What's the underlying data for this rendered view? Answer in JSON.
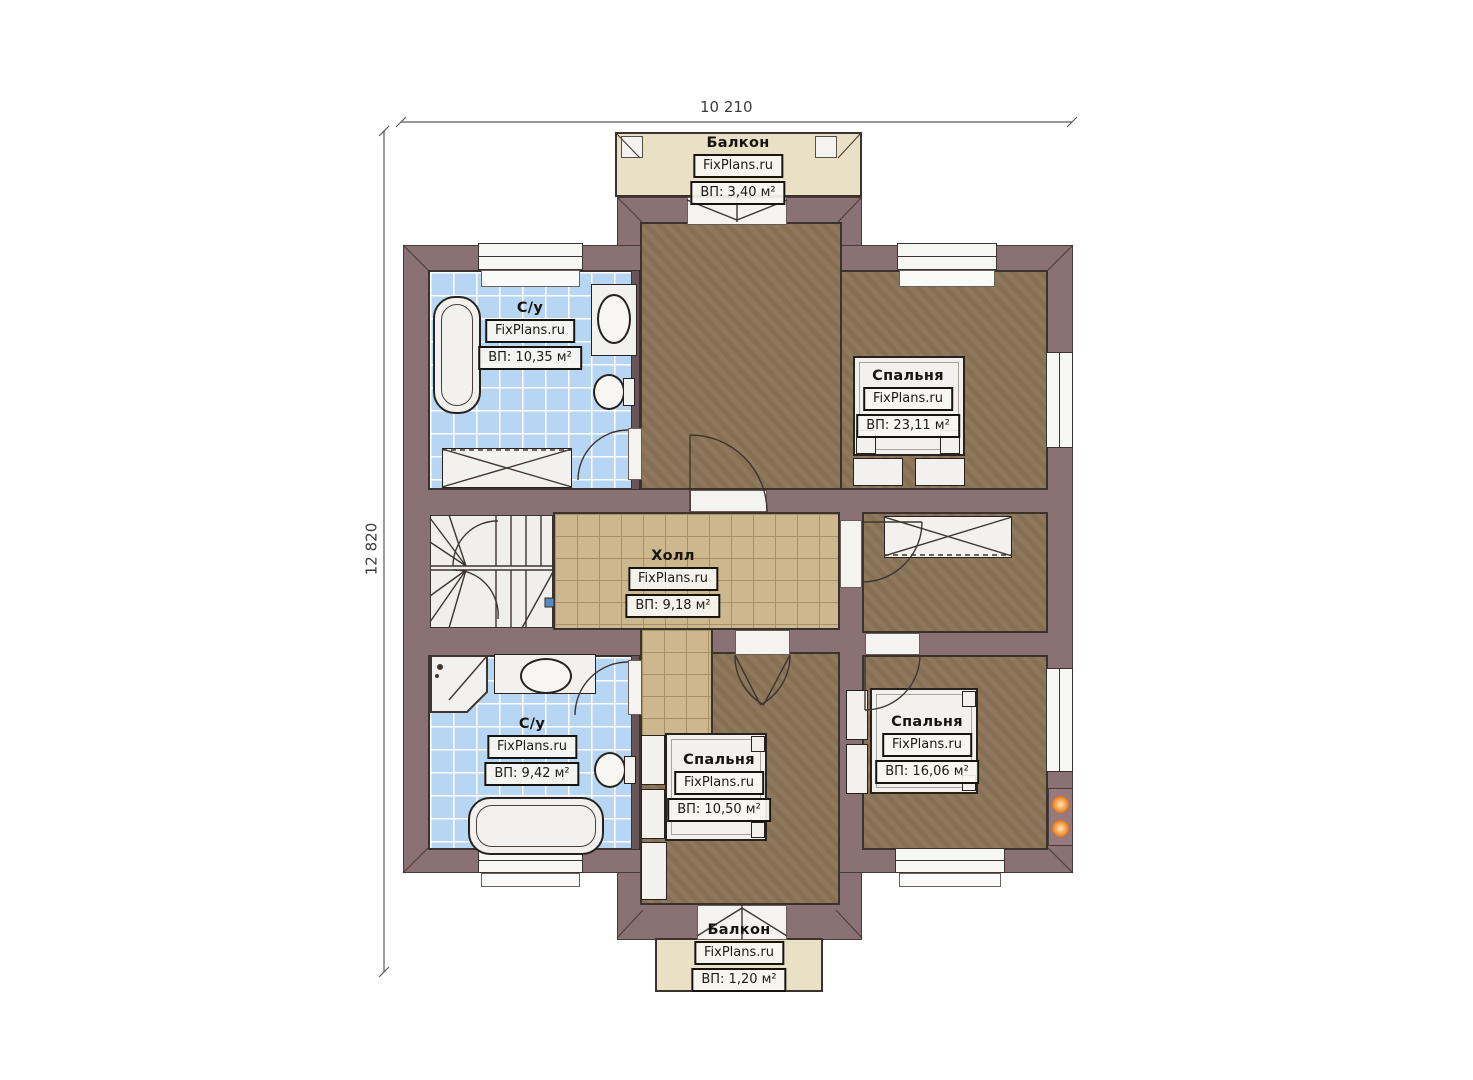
{
  "brand": "FixPlans.ru",
  "dimensions": {
    "width_label": "10 210",
    "height_label": "12 820"
  },
  "rooms": {
    "balcony_top": {
      "name": "Балкон",
      "area": "ВП: 3,40 м²"
    },
    "bathroom_top": {
      "name": "С/у",
      "area": "ВП: 10,35 м²"
    },
    "bedroom_main": {
      "name": "Спальня",
      "area": "ВП: 23,11 м²"
    },
    "hall": {
      "name": "Холл",
      "area": "ВП: 9,18 м²"
    },
    "bathroom_bottom": {
      "name": "С/у",
      "area": "ВП: 9,42 м²"
    },
    "bedroom_center": {
      "name": "Спальня",
      "area": "ВП: 10,50 м²"
    },
    "bedroom_right": {
      "name": "Спальня",
      "area": "ВП: 16,06 м²"
    },
    "balcony_bottom": {
      "name": "Балкон",
      "area": "ВП: 1,20 м²"
    }
  },
  "colors": {
    "wall": "#8a7173",
    "bathroom_tile": "#b7d6f3",
    "hall_tile": "#cdb78c",
    "bedroom_floor": "#8b7457",
    "balcony_floor": "#e9e0c6",
    "stair_marker_blue": "#5d88c4",
    "vent_dot_orange": "#e0741f"
  }
}
